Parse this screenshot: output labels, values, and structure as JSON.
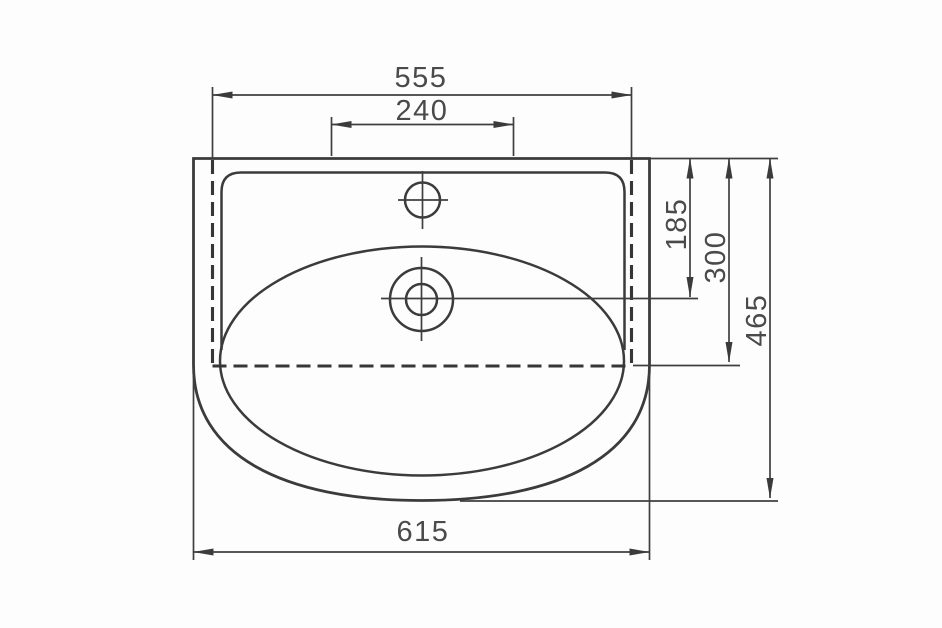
{
  "drawing": {
    "subject": "washbasin-top-view-dimension-drawing",
    "background_color": "#fdfdfd",
    "line_color": "#3b3b3b",
    "label_color": "#4a4a4a",
    "dims": {
      "hidden_edge_width": "555",
      "faucet_hole_spacing": "240",
      "rim_to_drain_center": "185",
      "rim_to_hidden_edge": "300",
      "overall_depth": "465",
      "overall_width": "615"
    }
  }
}
